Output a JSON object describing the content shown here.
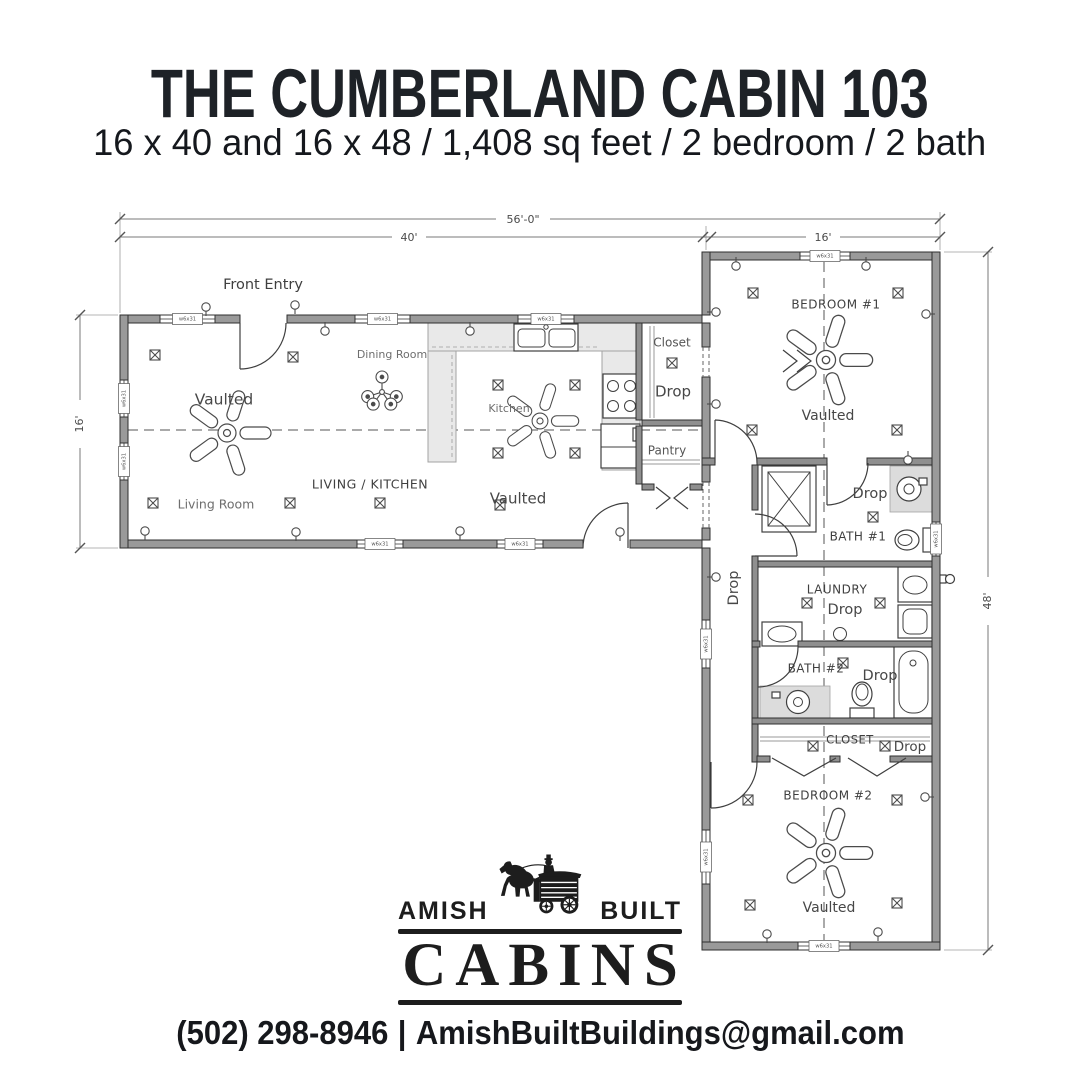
{
  "header": {
    "title": "THE CUMBERLAND CABIN 103",
    "subtitle": "16 x 40 and 16 x 48 / 1,408 sq feet / 2 bedroom / 2 bath"
  },
  "plan": {
    "colors": {
      "wall": "#9a9a9a",
      "wall_edge": "#2f2f2f",
      "counter": "#e9e9e9",
      "tile": "#dcdcdc"
    },
    "window_tag": "w6x31",
    "labels": [
      {
        "id": "front-entry",
        "text": "Front Entry",
        "x": 263,
        "y": 285,
        "size": 14.5,
        "color": "#3f3f3f"
      },
      {
        "id": "dining-room",
        "text": "Dining Room",
        "x": 392,
        "y": 355,
        "size": 11,
        "color": "#6e6e6e"
      },
      {
        "id": "vaulted-living",
        "text": "Vaulted",
        "x": 224,
        "y": 400,
        "size": 15.5,
        "color": "#474747"
      },
      {
        "id": "kitchen",
        "text": "Kitchen",
        "x": 509,
        "y": 409,
        "size": 11,
        "color": "#6e6e6e"
      },
      {
        "id": "living-kitchen",
        "text": "LIVING / KITCHEN",
        "x": 370,
        "y": 485,
        "size": 12.5,
        "color": "#3f3f3f",
        "ls": 0.5
      },
      {
        "id": "living-room",
        "text": "Living Room",
        "x": 216,
        "y": 505,
        "size": 12.5,
        "color": "#6e6e6e"
      },
      {
        "id": "vaulted-kitchen",
        "text": "Vaulted",
        "x": 518,
        "y": 499,
        "size": 15,
        "color": "#474747"
      },
      {
        "id": "closet-1",
        "text": "Closet",
        "x": 672,
        "y": 343,
        "size": 12,
        "color": "#555555"
      },
      {
        "id": "drop-closet-1",
        "text": "Drop",
        "x": 673,
        "y": 392,
        "size": 15,
        "color": "#474747"
      },
      {
        "id": "pantry",
        "text": "Pantry",
        "x": 667,
        "y": 451,
        "size": 12,
        "color": "#555555"
      },
      {
        "id": "bedroom-1",
        "text": "BEDROOM #1",
        "x": 836,
        "y": 305,
        "size": 12,
        "color": "#3f3f3f",
        "ls": 0.5
      },
      {
        "id": "vaulted-bedroom-1",
        "text": "Vaulted",
        "x": 828,
        "y": 416,
        "size": 14,
        "color": "#474747"
      },
      {
        "id": "drop-bath-1",
        "text": "Drop",
        "x": 870,
        "y": 494,
        "size": 14.5,
        "color": "#474747"
      },
      {
        "id": "bath-1",
        "text": "BATH #1",
        "x": 858,
        "y": 537,
        "size": 12,
        "color": "#3f3f3f",
        "ls": 0.5
      },
      {
        "id": "laundry",
        "text": "LAUNDRY",
        "x": 837,
        "y": 590,
        "size": 12,
        "color": "#3f3f3f",
        "ls": 0.5
      },
      {
        "id": "drop-laundry",
        "text": "Drop",
        "x": 845,
        "y": 610,
        "size": 14.5,
        "color": "#474747"
      },
      {
        "id": "drop-hall",
        "text": "Drop",
        "x": 734,
        "y": 588,
        "size": 14.5,
        "color": "#474747",
        "rot": -90
      },
      {
        "id": "bath-2",
        "text": "BATH #2",
        "x": 816,
        "y": 669,
        "size": 12,
        "color": "#3f3f3f",
        "ls": 0.5
      },
      {
        "id": "drop-bath-2",
        "text": "Drop",
        "x": 880,
        "y": 676,
        "size": 14.5,
        "color": "#474747"
      },
      {
        "id": "closet-2",
        "text": "CLOSET",
        "x": 850,
        "y": 740,
        "size": 11.5,
        "color": "#3f3f3f",
        "ls": 0.5
      },
      {
        "id": "drop-closet-2",
        "text": "Drop",
        "x": 910,
        "y": 747,
        "size": 13.5,
        "color": "#474747"
      },
      {
        "id": "bedroom-2",
        "text": "BEDROOM #2",
        "x": 828,
        "y": 796,
        "size": 12,
        "color": "#3f3f3f",
        "ls": 0.5
      },
      {
        "id": "vaulted-bedroom-2",
        "text": "Vaulted",
        "x": 829,
        "y": 908,
        "size": 14,
        "color": "#474747"
      }
    ],
    "dims": [
      {
        "id": "overall-width",
        "text": "56'-0\"",
        "x": 523,
        "y": 220
      },
      {
        "id": "left-wing-width",
        "text": "40'",
        "x": 409,
        "y": 238
      },
      {
        "id": "right-wing-width",
        "text": "16'",
        "x": 823,
        "y": 238
      },
      {
        "id": "left-wing-depth",
        "text": "16'",
        "x": 80,
        "y": 424,
        "rot": -90
      },
      {
        "id": "right-wing-depth",
        "text": "48'",
        "x": 988,
        "y": 601,
        "rot": -90
      }
    ]
  },
  "logo": {
    "amish": "AMISH",
    "built": "BUILT",
    "cabins": "CABINS"
  },
  "footer": {
    "phone": "(502) 298-8946",
    "sep": "|",
    "email": "AmishBuiltBuildings@gmail.com"
  }
}
